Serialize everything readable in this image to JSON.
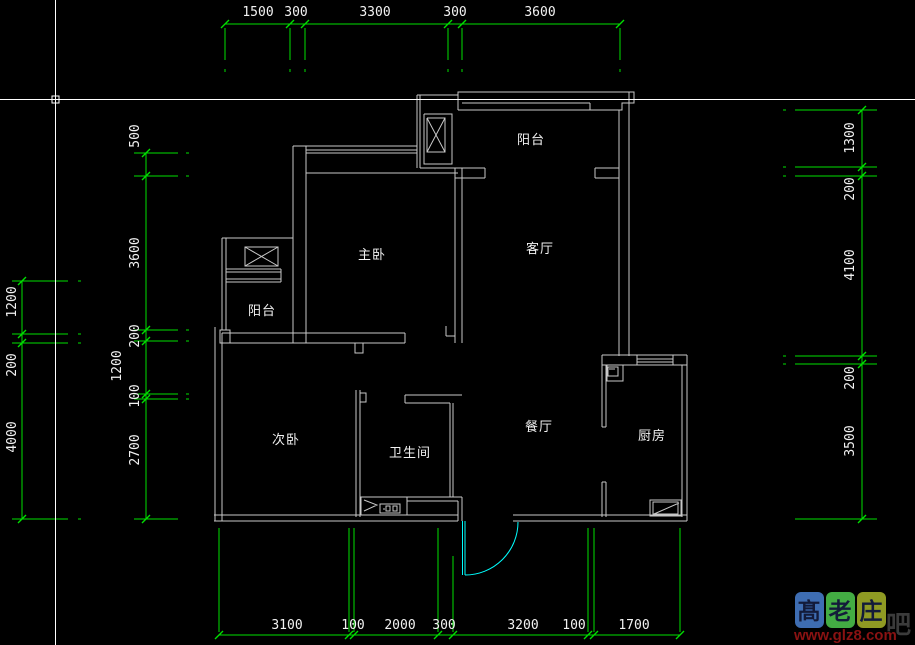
{
  "canvas": {
    "background": "#000000",
    "wall_color": "#c8c8c8",
    "dim_color": "#00e000",
    "text_color": "#f2f2f2",
    "door_color": "#00ffff",
    "cursor_color": "#ffffff"
  },
  "rooms": {
    "balcony_top": "阳台",
    "master_bedroom": "主卧",
    "living_room": "客厅",
    "balcony_left": "阳台",
    "second_bedroom": "次卧",
    "bathroom": "卫生间",
    "dining_room": "餐厅",
    "kitchen": "厨房"
  },
  "dims": {
    "top": [
      "1500",
      "300",
      "3300",
      "300",
      "3600"
    ],
    "bottom": [
      "3100",
      "100",
      "2000",
      "300",
      "3200",
      "100",
      "1700"
    ],
    "left_outer": [
      "1200",
      "200",
      "4000"
    ],
    "left_inner": [
      "500",
      "3600",
      "200",
      "1200",
      "100",
      "2700"
    ],
    "right": [
      "1300",
      "200",
      "4100",
      "200",
      "3500"
    ]
  },
  "watermark": {
    "chars": [
      "髙",
      "老",
      "庄"
    ],
    "block_colors": [
      "#3e6db2",
      "#43ac43",
      "#8f9a23"
    ],
    "char_color": "#131b3a",
    "url": "www.glz8.com",
    "url_color": "#8a1212",
    "suffix": "吧",
    "suffix_color": "#4a4a4a"
  }
}
